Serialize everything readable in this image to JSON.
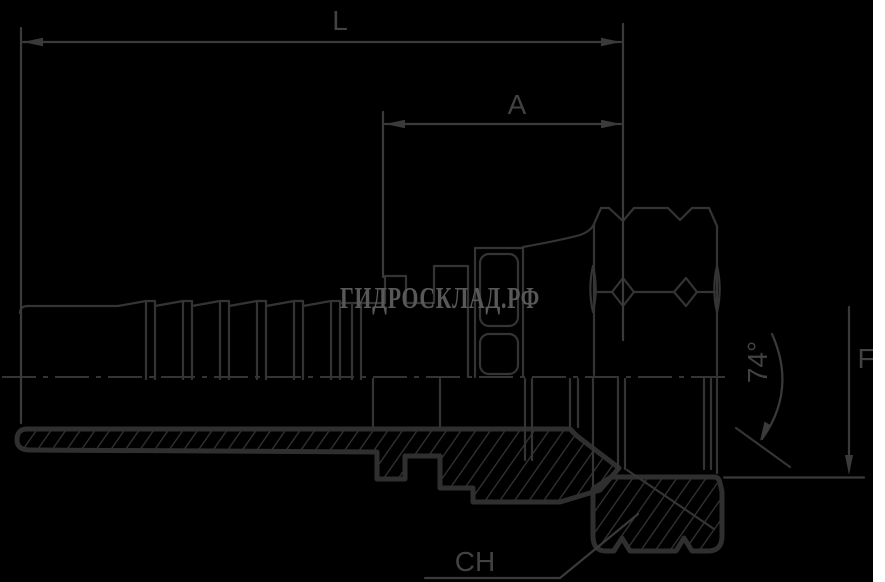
{
  "drawing": {
    "watermark": "ГИДРОСКЛАД.РФ",
    "labels": {
      "overall_length": "L",
      "thread_length": "A",
      "cone_angle": "74°",
      "seat_size": "F",
      "hex_size": "CH"
    },
    "colors": {
      "background": "#000000",
      "line": "#343434",
      "label": "#424242",
      "watermark": "#585858",
      "right_strip": "#ffffff"
    }
  }
}
